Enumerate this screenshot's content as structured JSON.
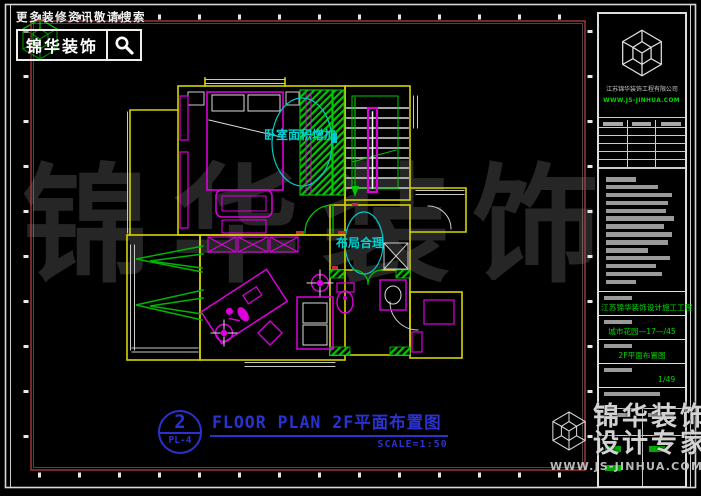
{
  "header": {
    "hint": "更多装修资讯敬请搜索",
    "brand": "锦华装饰"
  },
  "watermark_center": "锦华装饰",
  "plan": {
    "annotation_bedroom": "卧室面积增加",
    "annotation_layout": "布局合理",
    "title_number": "2",
    "title_sheet": "PL-4",
    "title_text": "FLOOR PLAN 2F平面布置图",
    "title_scale": "SCALE=1:50"
  },
  "title_block": {
    "company": "江苏锦华装饰工程有限公司",
    "company_site": "WWW.JS-JINHUA.COM",
    "notes_bar_widths": [
      30,
      52,
      66,
      62,
      60,
      68,
      58,
      66,
      62,
      42,
      64,
      50,
      56,
      30
    ],
    "fields": [
      {
        "value": "江苏锦华装饰设计施工工程"
      },
      {
        "value": "城市花园—17—/45"
      },
      {
        "value": "2F平面布置图"
      },
      {
        "value": "1/49"
      }
    ]
  },
  "footer": {
    "brand": "锦华装饰",
    "tagline": "设计专家",
    "site": "WWW.JS-JINHUA.COM"
  },
  "colors": {
    "wall_yellow": "#d4d400",
    "furniture_magenta": "#dd00dd",
    "fitting_green": "#00c800",
    "annotation_cyan": "#00cccc",
    "title_blue": "#2a32cf",
    "frame_red": "#a83a3a"
  }
}
